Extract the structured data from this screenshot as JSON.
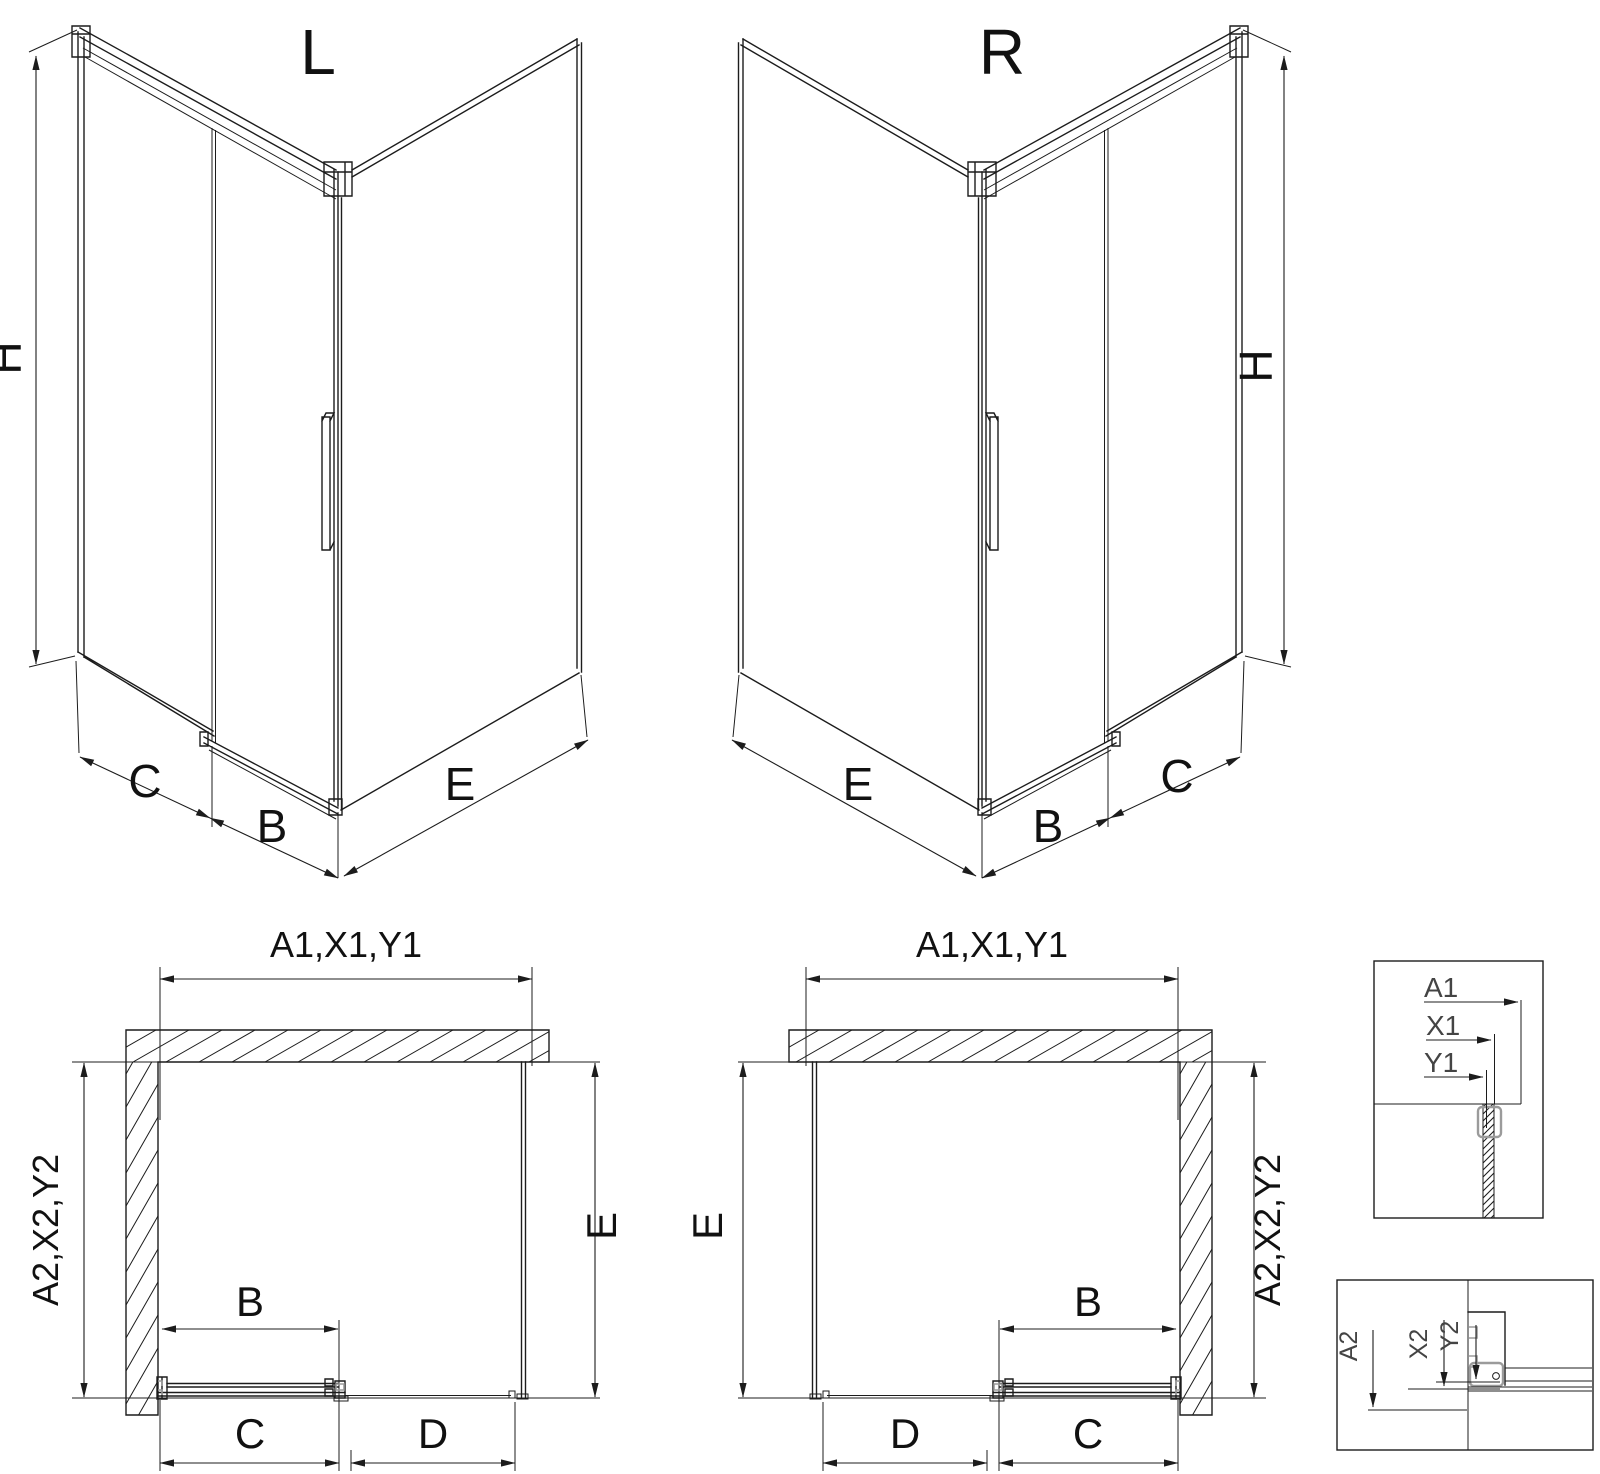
{
  "views": {
    "iso_left": {
      "title": "L",
      "height_label": "H",
      "fixed_label": "C",
      "door_label": "B",
      "side_label": "E"
    },
    "iso_right": {
      "title": "R",
      "height_label": "H",
      "fixed_label": "C",
      "door_label": "B",
      "side_label": "E"
    },
    "plan_left": {
      "top_dim": "A1,X1,Y1",
      "side_dim": "A2,X2,Y2",
      "side_panel_dim": "E",
      "door_dim": "B",
      "opening_dim": "C",
      "fixed_glass_dim": "D"
    },
    "plan_right": {
      "top_dim": "A1,X1,Y1",
      "side_dim": "A2,X2,Y2",
      "side_panel_dim": "E",
      "door_dim": "B",
      "opening_dim": "C",
      "fixed_glass_dim": "D"
    },
    "detail_glass_top": {
      "dims": [
        "A1",
        "X1",
        "Y1"
      ]
    },
    "detail_profile_bottom": {
      "dims": [
        "A2",
        "X2",
        "Y2"
      ]
    }
  },
  "colors": {
    "line": "#1c1c1c",
    "profile_gray": "#9b9b9b",
    "detail_text": "#444444",
    "background": "#ffffff"
  }
}
